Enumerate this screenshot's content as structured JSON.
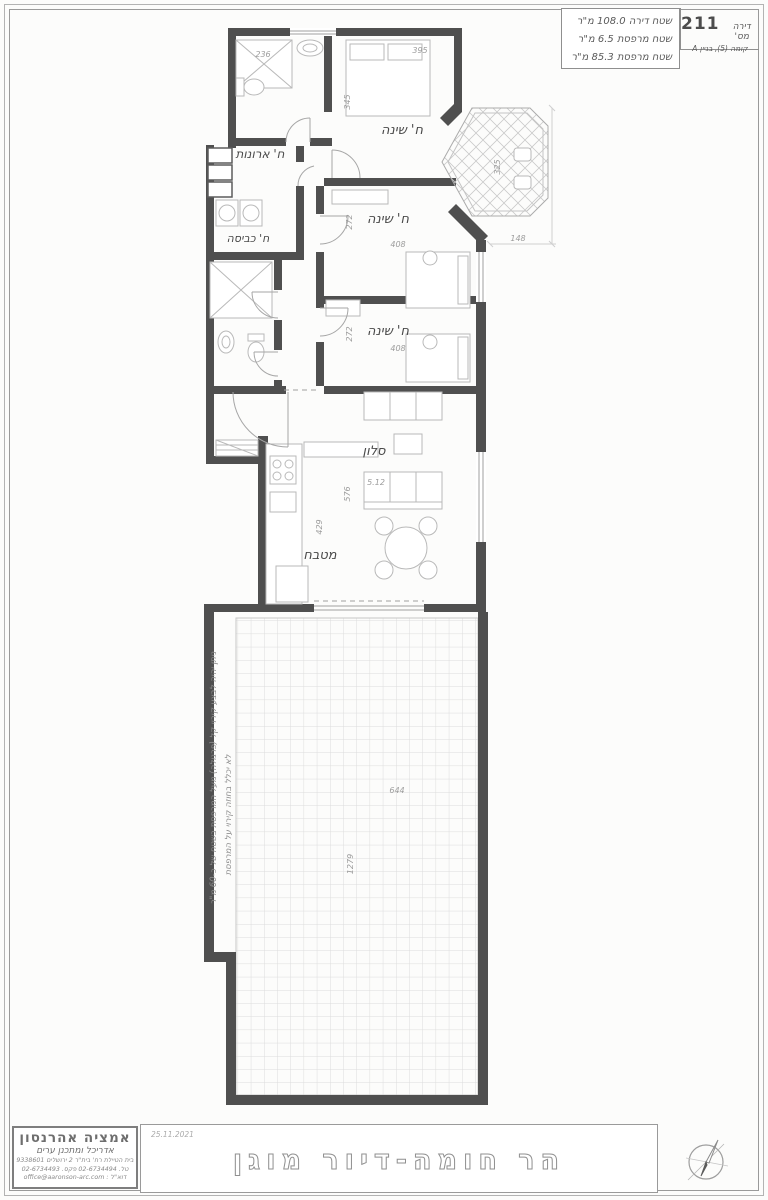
{
  "header": {
    "apt_label": "דירה מס'",
    "apt_number": "211",
    "floor_line": "קומה (5), בניין A",
    "area_lines": {
      "apartment": "שטח דירה 108.0 מ\"ר",
      "balcony": "שטח מרפסת 6.5 מ\"ר",
      "terrace": "שטח מרפסת 85.3 מ\"ר"
    }
  },
  "plan": {
    "rooms": {
      "bedroom1": "ח' שינה",
      "bedroom2": "ח' שינה",
      "bedroom3": "ח' שינה",
      "closet": "ח' ארונות",
      "laundry": "ח' כביסה",
      "living": "סלון",
      "kitchen": "מטבח"
    },
    "dims": {
      "shower": "236",
      "bed1_w": "395",
      "bed1_h": "345",
      "bed2_h": "272",
      "bed2_w": "408",
      "bed3_h": "272",
      "bed3_w": "408",
      "living_w": "5.12",
      "living_h": "576",
      "kitchen_h": "429",
      "balcony_h": "325",
      "balcony_w": "148",
      "terrace_w": "644",
      "terrace_h": "1279"
    },
    "terrace_note_line1": "לא יכלל בחוזה קירוי על המרפסת",
    "terrace_note_line2": "ניתן יהיה לבצע קירוי קל (פרגולה) מעל המרפסת בשטח של כ-60 מ\"ר"
  },
  "titlebar": {
    "firm_name": "אמציה אהרנסון",
    "firm_role": "אדריכל ומתכנן ערים",
    "firm_address": "בית הטיילת רח' בית\"ר 2 ירושלים 9338601",
    "firm_phone": "טל. 02-6734494 פקס. 02-6734493",
    "firm_email": "דוא\"ל : office@aaronson-arc.com",
    "date": "25.11.2021",
    "project_title": "הר חומה-דיור מוגן"
  },
  "icons": {
    "compass": "north-arrow-icon"
  }
}
